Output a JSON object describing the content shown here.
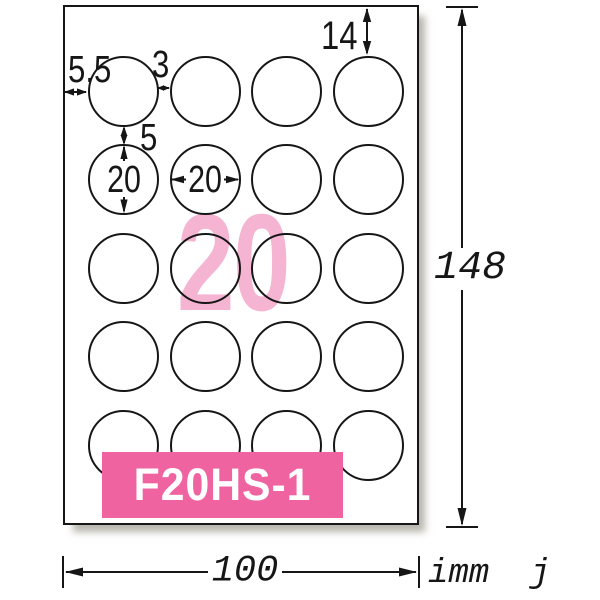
{
  "sheet": {
    "grid_rows": 5,
    "grid_cols": 4,
    "count_label": "20",
    "product_code": "F20HS-1"
  },
  "annotations": {
    "top_margin": "14",
    "left_margin": "5.5",
    "horizontal_gap": "3",
    "vertical_gap": "5",
    "diameter_vertical": "20",
    "diameter_horizontal": "20"
  },
  "dimensions": {
    "sheet_height": "148",
    "sheet_width": "100",
    "unit_note": "imm  j"
  },
  "colors": {
    "line": "#161616",
    "code_box_bg": "#ef63a1",
    "count_pink": "#f6b4d3"
  }
}
